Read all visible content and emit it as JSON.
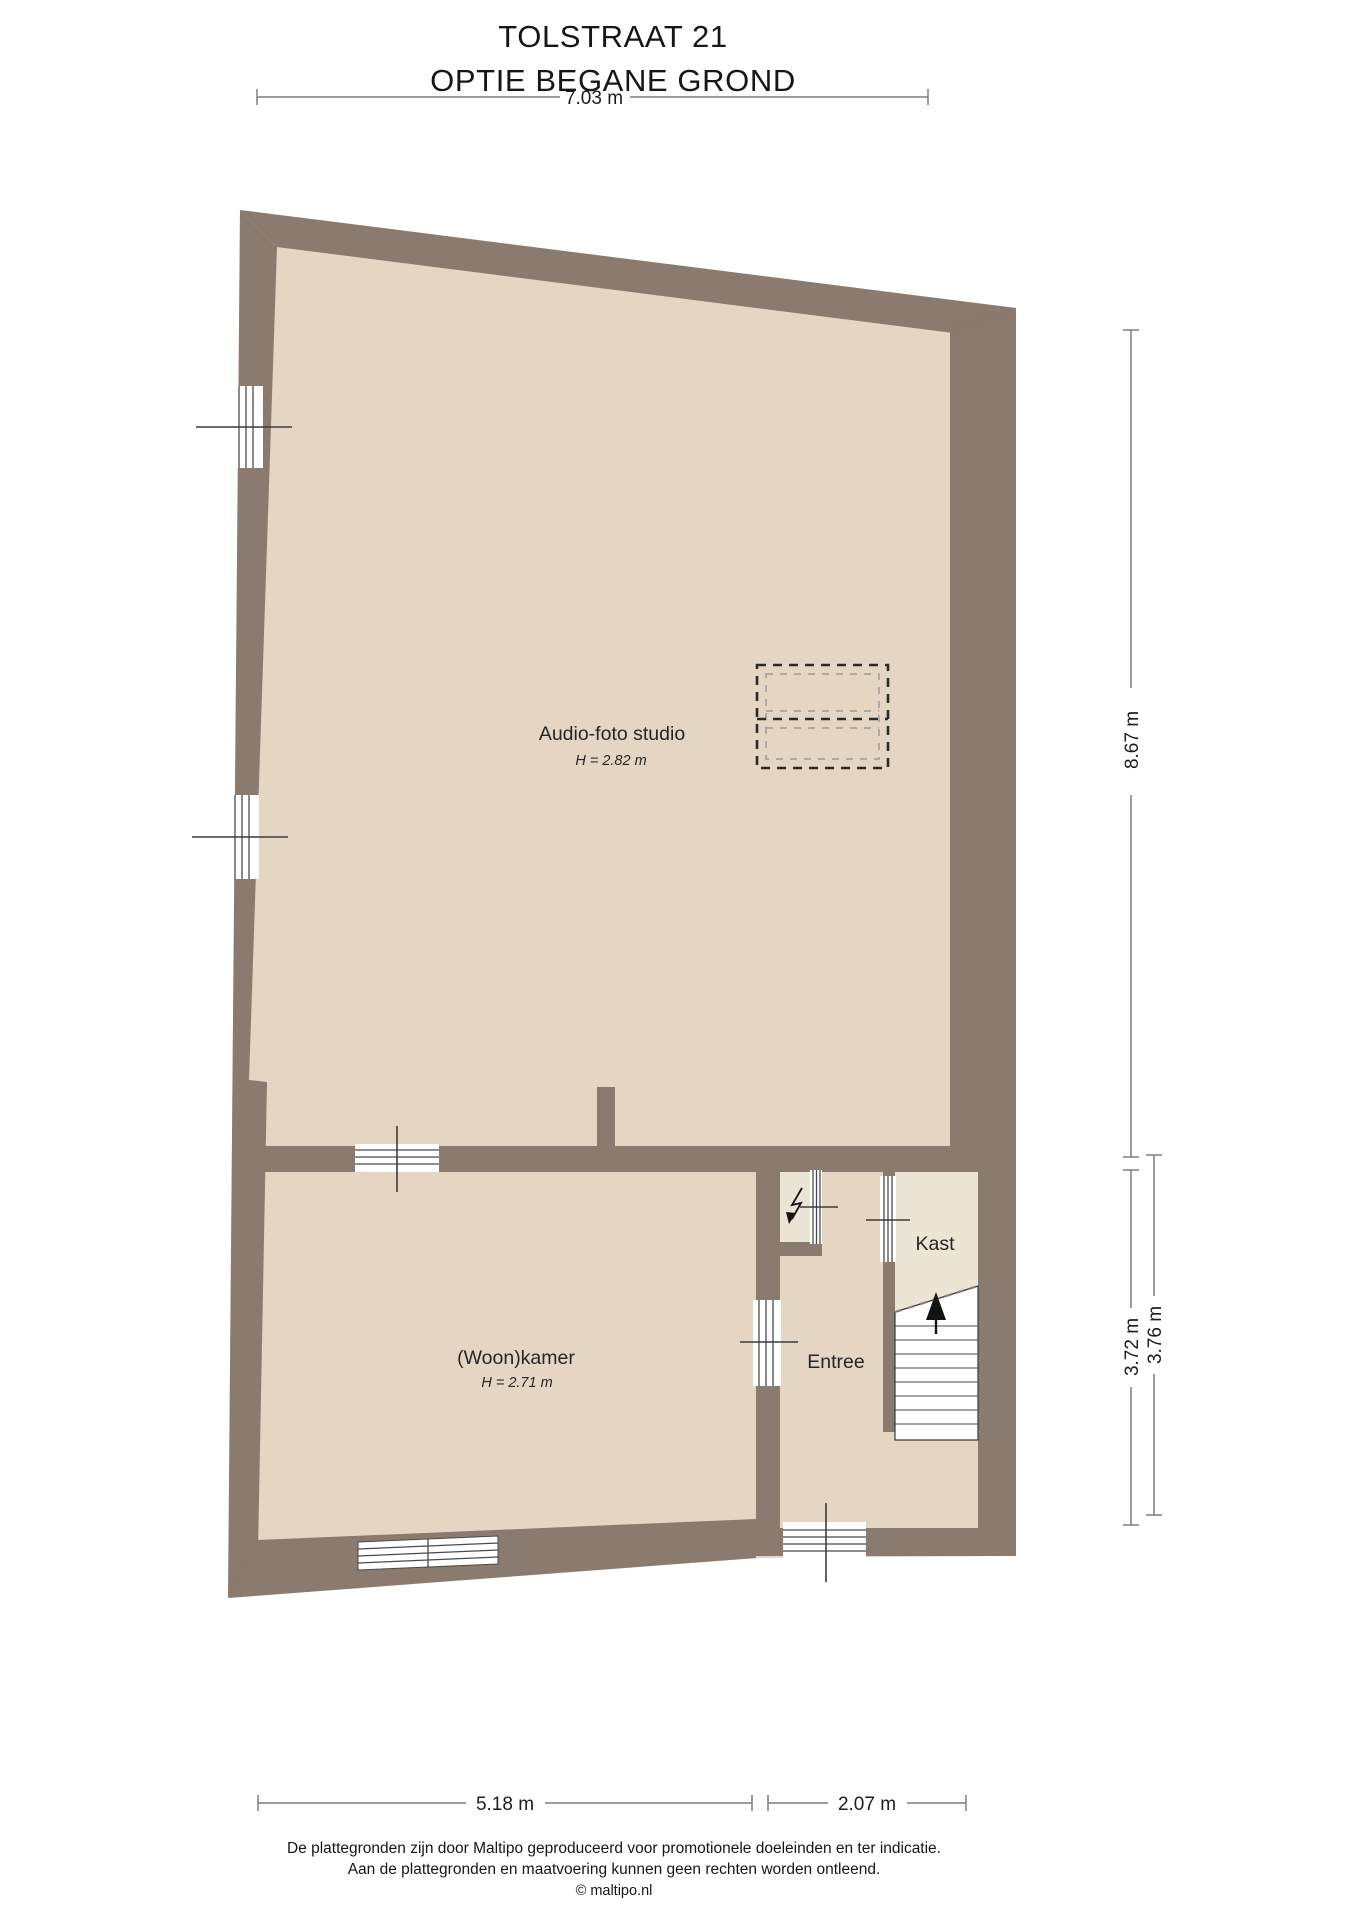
{
  "title": {
    "line1": "TOLSTRAAT 21",
    "line2": "OPTIE BEGANE GROND"
  },
  "rooms": {
    "studio": {
      "name": "Audio-foto studio",
      "ceiling": "H = 2.82 m"
    },
    "woonkamer": {
      "name": "(Woon)kamer",
      "ceiling": "H = 2.71 m"
    },
    "entree": {
      "name": "Entree"
    },
    "kast": {
      "name": "Kast"
    }
  },
  "dimensions": {
    "top_width": "7.03 m",
    "right_height": "8.67 m",
    "right_lower_inner": "3.72 m",
    "right_lower_outer": "3.76 m",
    "bottom_left_width": "5.18 m",
    "bottom_right_width": "2.07 m"
  },
  "footer": {
    "line1": "De plattegronden zijn door Maltipo geproduceerd voor promotionele doeleinden en ter indicatie.",
    "line2": "Aan de plattegronden en maatvoering kunnen geen rechten worden ontleend.",
    "line3": "© maltipo.nl"
  },
  "colors": {
    "wall": "#8a7b6e",
    "floor": "#e4d6c2",
    "floor_light": "#ece4d5",
    "dash_dark": "#2a2a2a",
    "dash_light": "#9b9b9b",
    "dim_line": "#7d7d7d",
    "tick": "#3c3c3c",
    "window_line": "#4a4a4a",
    "text": "#1f1f1f"
  }
}
